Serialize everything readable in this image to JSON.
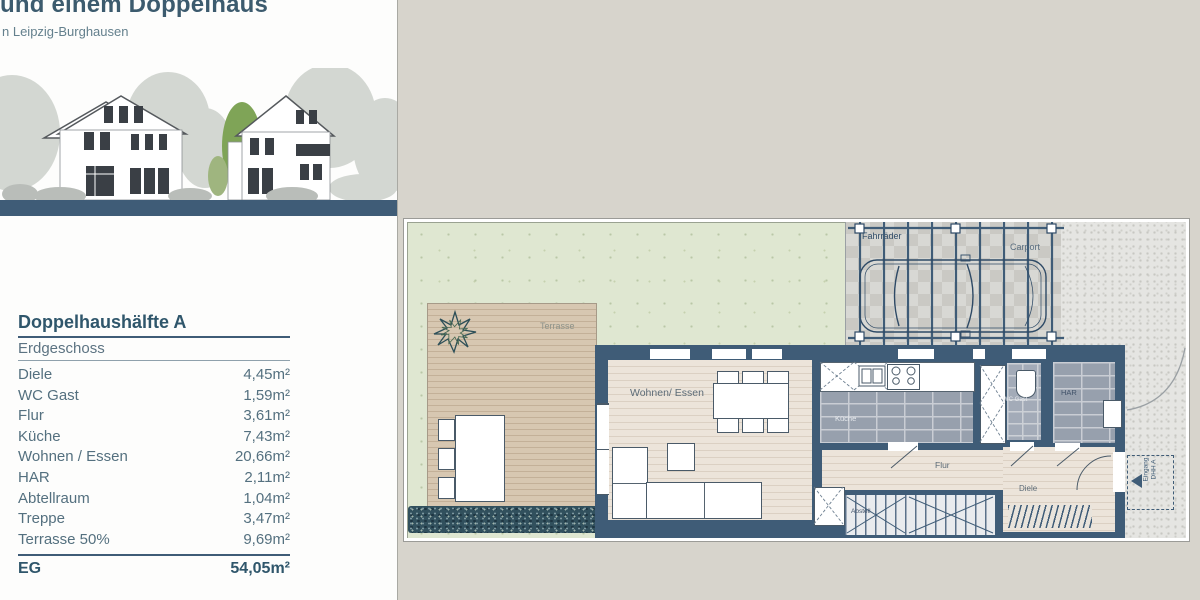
{
  "header": {
    "title": "und einem Doppelhaus",
    "subtitle": "n Leipzig-Burghausen"
  },
  "area_table": {
    "title": "Doppelhaushälfte A",
    "floor_label": "Erdgeschoss",
    "rows": [
      {
        "label": "Diele",
        "value": "4,45m²"
      },
      {
        "label": "WC Gast",
        "value": "1,59m²"
      },
      {
        "label": "Flur",
        "value": "3,61m²"
      },
      {
        "label": "Küche",
        "value": "7,43m²"
      },
      {
        "label": "Wohnen / Essen",
        "value": "20,66m²"
      },
      {
        "label": "HAR",
        "value": "2,11m²"
      },
      {
        "label": "Abtellraum",
        "value": "1,04m²"
      },
      {
        "label": "Treppe",
        "value": "3,47m²"
      },
      {
        "label": "Terrasse 50%",
        "value": "9,69m²"
      }
    ],
    "total": {
      "label": "EG",
      "value": "54,05m²"
    }
  },
  "floor_plan": {
    "labels": {
      "terrasse": "Terrasse",
      "wohnen_essen": "Wohnen/ Essen",
      "kueche": "Küche",
      "wc_gast": "WC Gast",
      "har": "HAR",
      "flur": "Flur",
      "diele": "Diele",
      "abstell": "Abstell",
      "fahrraeder": "Fahrräder",
      "carport": "Carport",
      "eingang_line1": "Eingang",
      "eingang_line2": "DHH A"
    }
  },
  "colors": {
    "accent_wall": "#3f5c77",
    "title_text": "#3c5b6e",
    "table_text": "#54707f",
    "garden_green": "#dfe7d1",
    "terrace_wood": "#d6c6b0",
    "living_wood": "#ece4da",
    "tile_gray": "#97a0ad",
    "paving_gray": "#e4e4e2",
    "page_bg": "#d7d4cc"
  }
}
